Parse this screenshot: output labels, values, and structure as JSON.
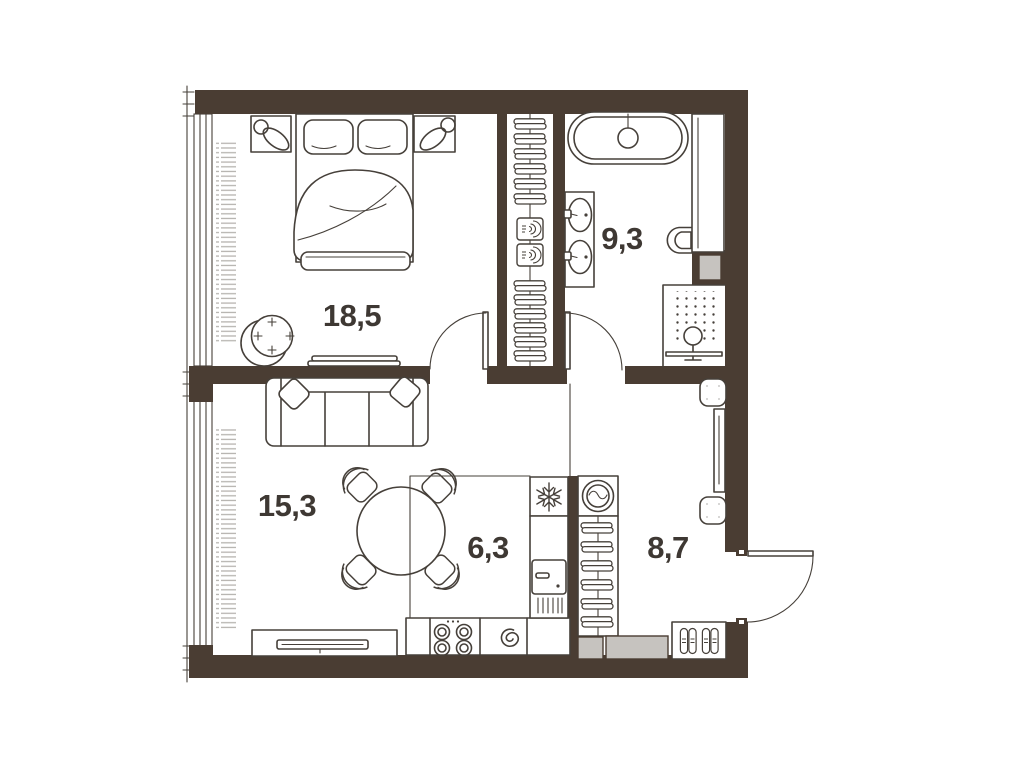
{
  "rooms": [
    {
      "id": "bedroom",
      "area": "18,5"
    },
    {
      "id": "bathroom",
      "area": "9,3"
    },
    {
      "id": "living",
      "area": "15,3"
    },
    {
      "id": "kitchen",
      "area": "6,3"
    },
    {
      "id": "hallway",
      "area": "8,7"
    }
  ],
  "colors": {
    "wall": "#4a3d33",
    "line": "#46403a",
    "shaft_fill": "#c6c3bf",
    "radiator_hatch": "#b6b3af",
    "label_text": "#3e3833",
    "background": "#ffffff"
  },
  "fixtures": {
    "bedroom": [
      "double-bed",
      "pillows",
      "nightstand-left",
      "nightstand-right",
      "table-lamp-left",
      "table-lamp-right",
      "armchair",
      "tv-stand",
      "radiator",
      "window"
    ],
    "bathroom": [
      "bathtub",
      "double-washbasin",
      "toilet",
      "shower",
      "storage-column",
      "duct-shaft",
      "door"
    ],
    "living": [
      "sofa",
      "cushions",
      "round-dining-table",
      "dining-chairs-x4",
      "tv-console",
      "radiator",
      "window"
    ],
    "kitchen": [
      "fridge",
      "appliance-column",
      "stove-4-burners",
      "sink",
      "base-counter"
    ],
    "hallway": [
      "washing-machine",
      "hanger-wardrobe",
      "mirror",
      "pouf-top",
      "pouf-bottom",
      "shoe-rack",
      "duct-shafts",
      "entrance-door",
      "built-in-closet"
    ]
  }
}
